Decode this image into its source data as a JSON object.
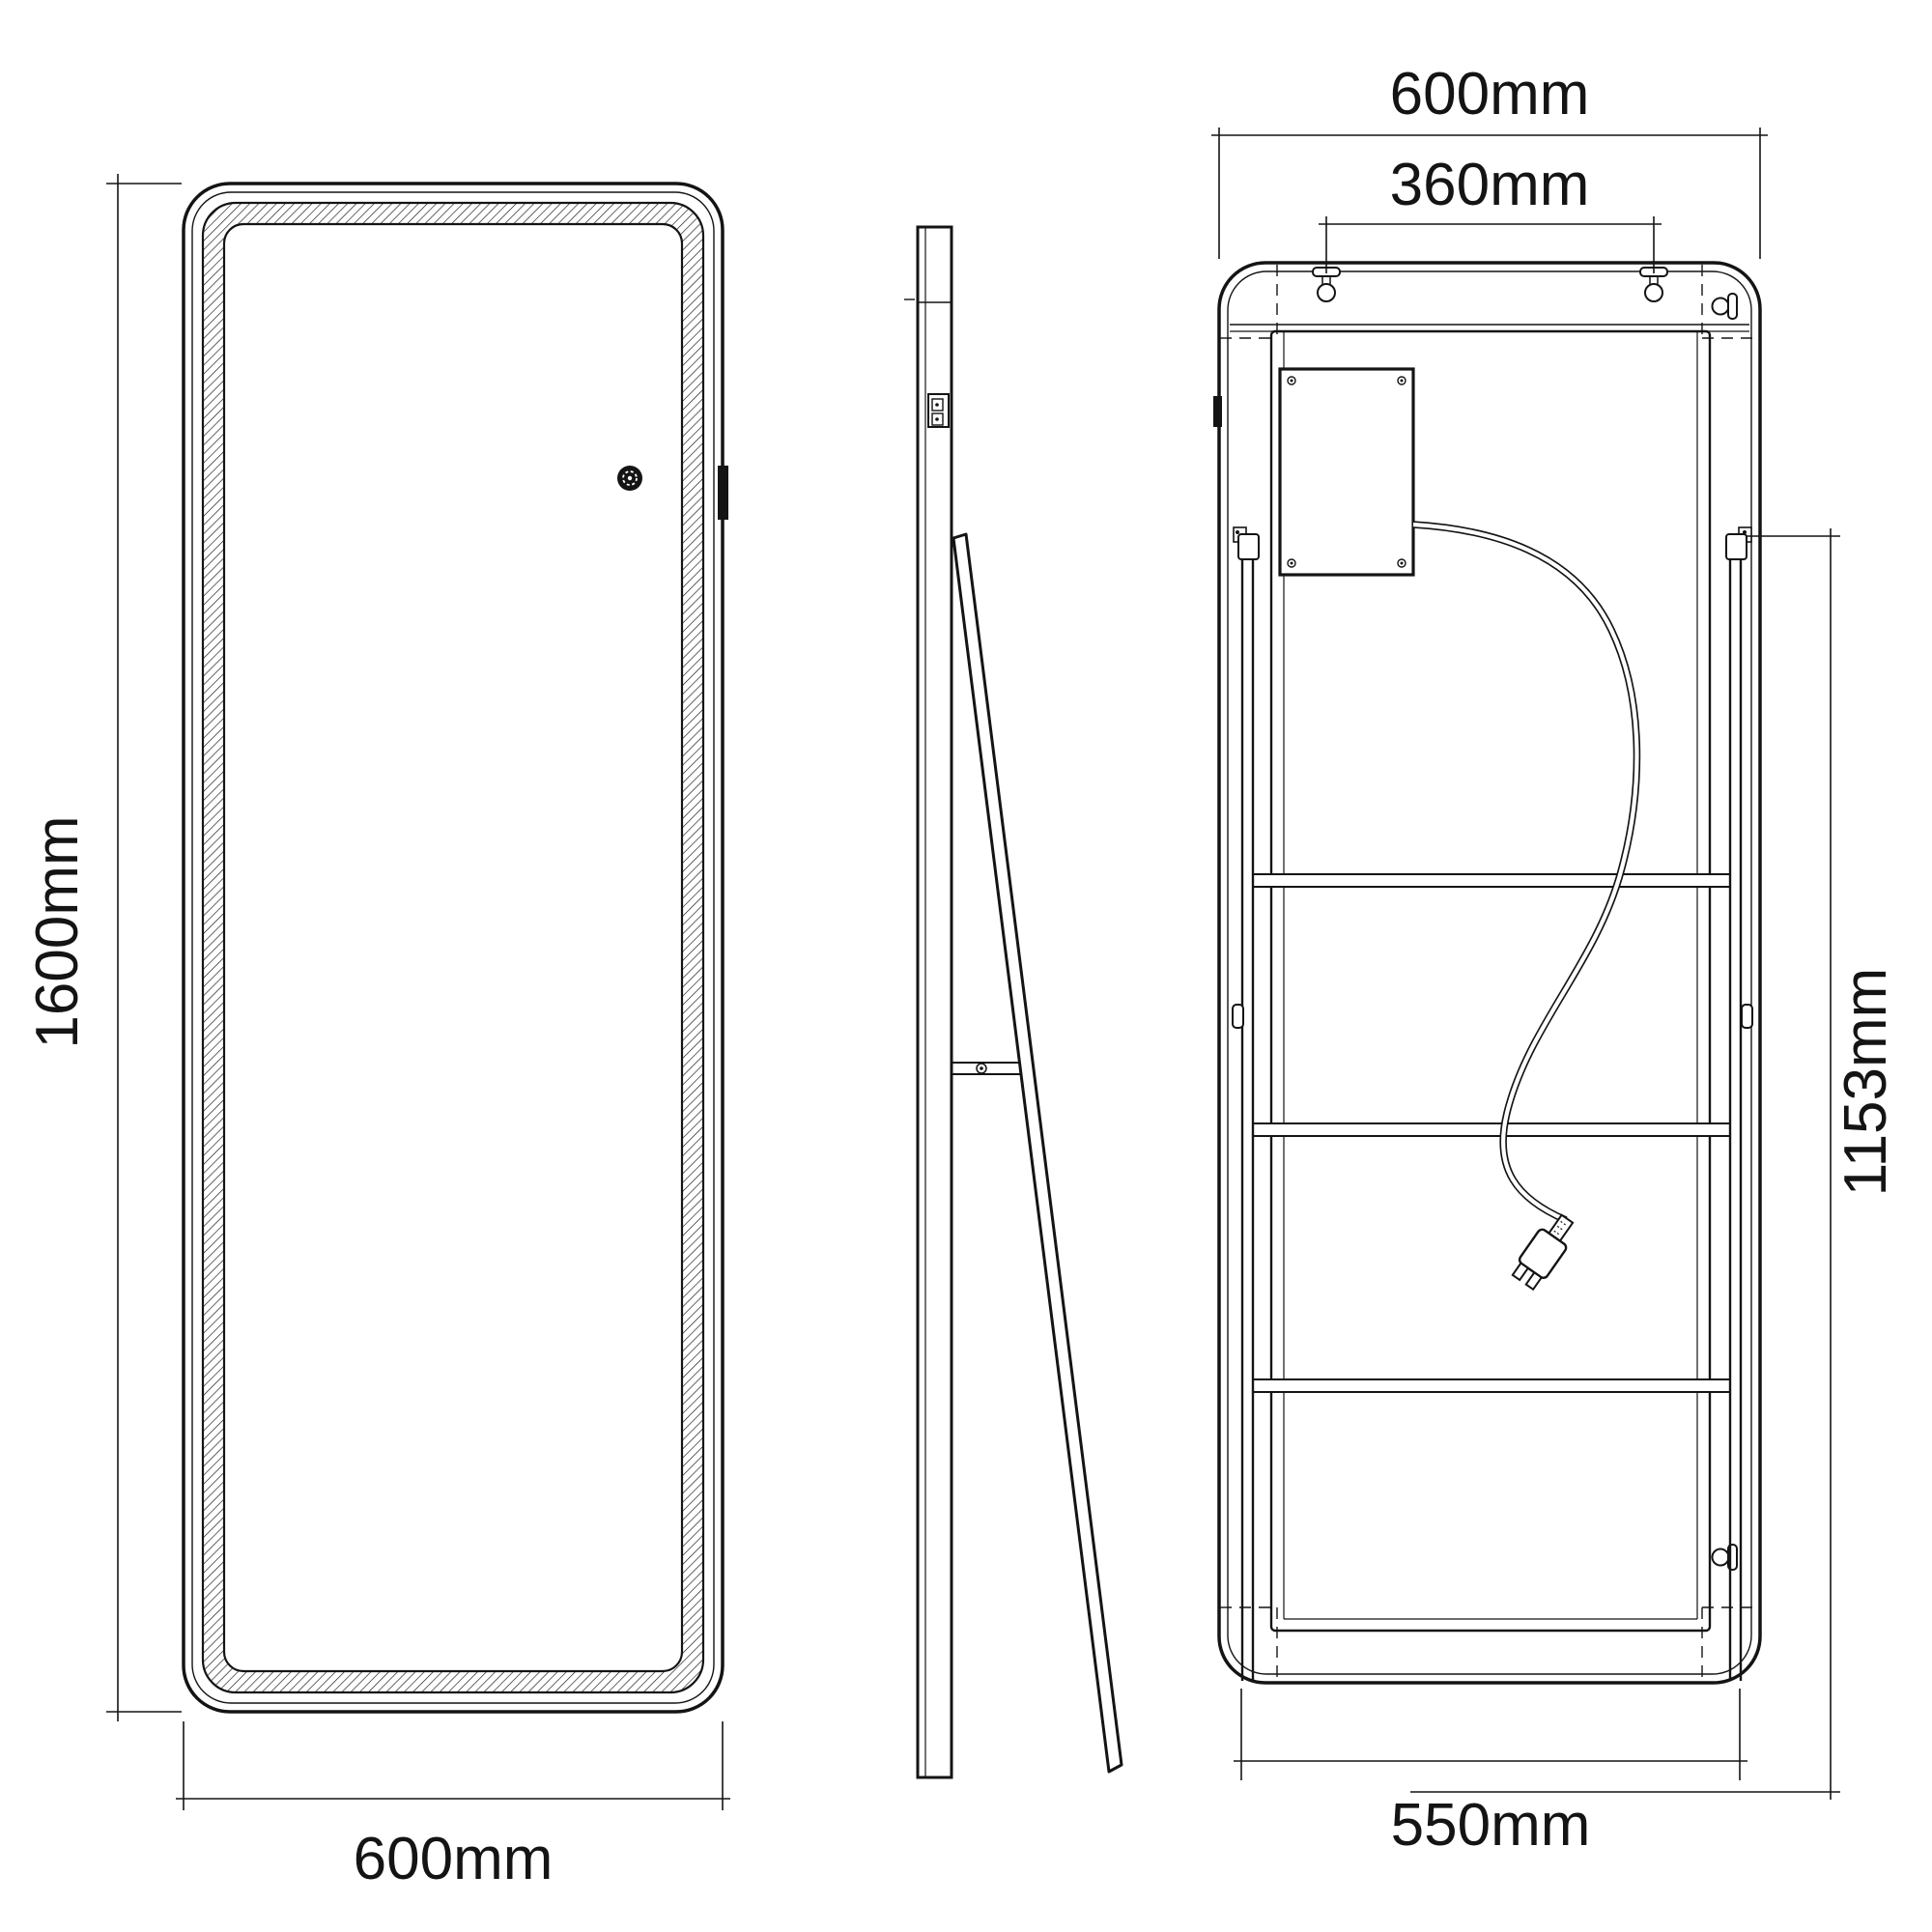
{
  "drawing": {
    "type": "technical-dimension-drawing",
    "subject": "full-length LED floor mirror with kickstand, front / side / back views",
    "colors": {
      "line": "#141414",
      "background": "#ffffff"
    }
  },
  "dims": {
    "front_height": "1600mm",
    "front_width": "600mm",
    "back_width": "600mm",
    "bracket_spacing": "360mm",
    "stand_height": "1153mm",
    "base_width": "550mm"
  }
}
